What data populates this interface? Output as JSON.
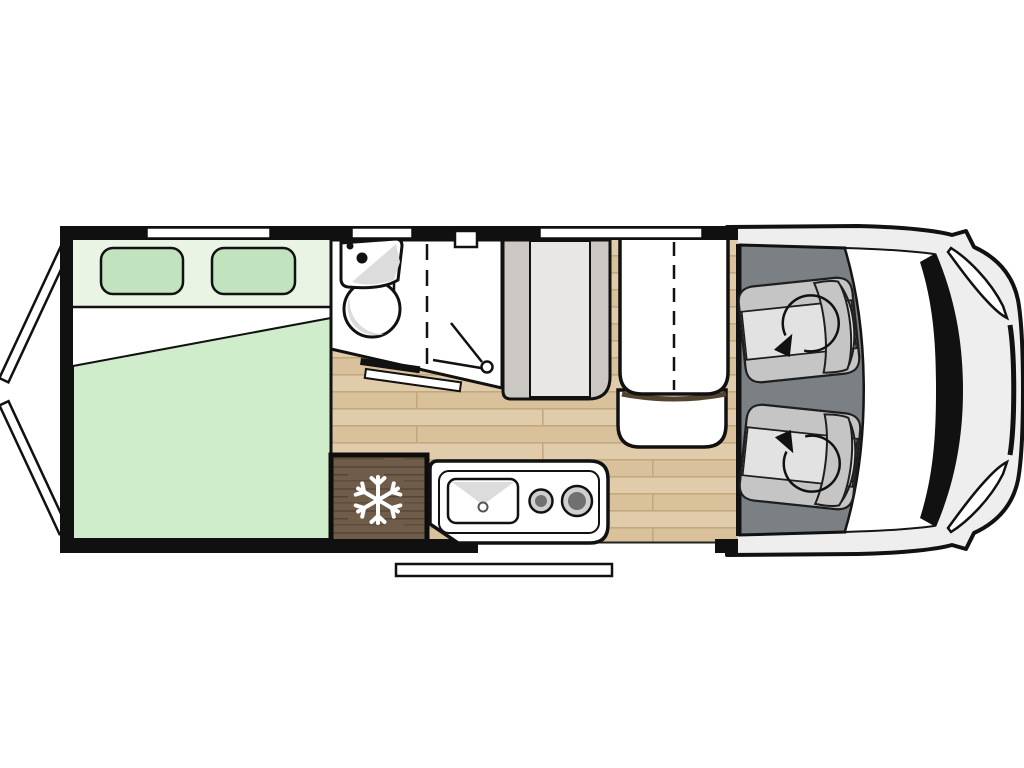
{
  "title": "Campervan top-view floor plan",
  "view": "top-down",
  "colors": {
    "background": "#ffffff",
    "wall": "#101010",
    "outline": "#151515",
    "bed_head": "#e9f4e5",
    "pillow": "#c1e4bf",
    "blanket": "#cfeccb",
    "bed_sheet": "#ffffff",
    "wood_floor": "#d9c19c",
    "wood_floor_light": "#e0cbaa",
    "wood_plank_line": "#c3a87e",
    "fridge_wood": "#6f5c49",
    "fridge_grain": "#554538",
    "snowflake": "#ffffff",
    "fixture_white": "#ffffff",
    "fixture_shade": "#dcdcdc",
    "cabinet_side": "#cbc8c4",
    "cabinet_center": "#e8e7e5",
    "cab_floor": "#7b8084",
    "seat_base": "#d8d8d8",
    "seat_bolster": "#c5c5c5",
    "seat_cushion": "#e2e2e2",
    "van_body": "#eeeeee",
    "windshield": "#ffffff",
    "dashboard": "#111111",
    "burner_ring": "#cfcfcf",
    "burner_center": "#707070",
    "table_shadow": "#54432f",
    "door_panel": "#ffffff",
    "step": "#ffffff"
  },
  "areas": [
    {
      "name": "rear-bedroom",
      "features": [
        "double-bed",
        "pillow-left",
        "pillow-right",
        "blanket",
        "rear-doors-open"
      ]
    },
    {
      "name": "bathroom",
      "features": [
        "corner-washbasin",
        "round-basin",
        "shower",
        "folding-door",
        "partition-dashed"
      ]
    },
    {
      "name": "kitchen",
      "features": [
        "refrigerator",
        "sink",
        "two-burner-hob",
        "entry-step"
      ]
    },
    {
      "name": "dinette",
      "features": [
        "wardrobe-cabinet",
        "folding-table",
        "bench-seat"
      ]
    },
    {
      "name": "cab",
      "features": [
        "swivel-seat-left",
        "swivel-seat-right",
        "windshield",
        "dashboard",
        "headlights"
      ]
    }
  ],
  "icons": [
    "snowflake-icon",
    "swivel-arrow-icon",
    "shower-head-icon",
    "burner-icon",
    "sink-drain-icon",
    "faucet-dots-icon"
  ]
}
